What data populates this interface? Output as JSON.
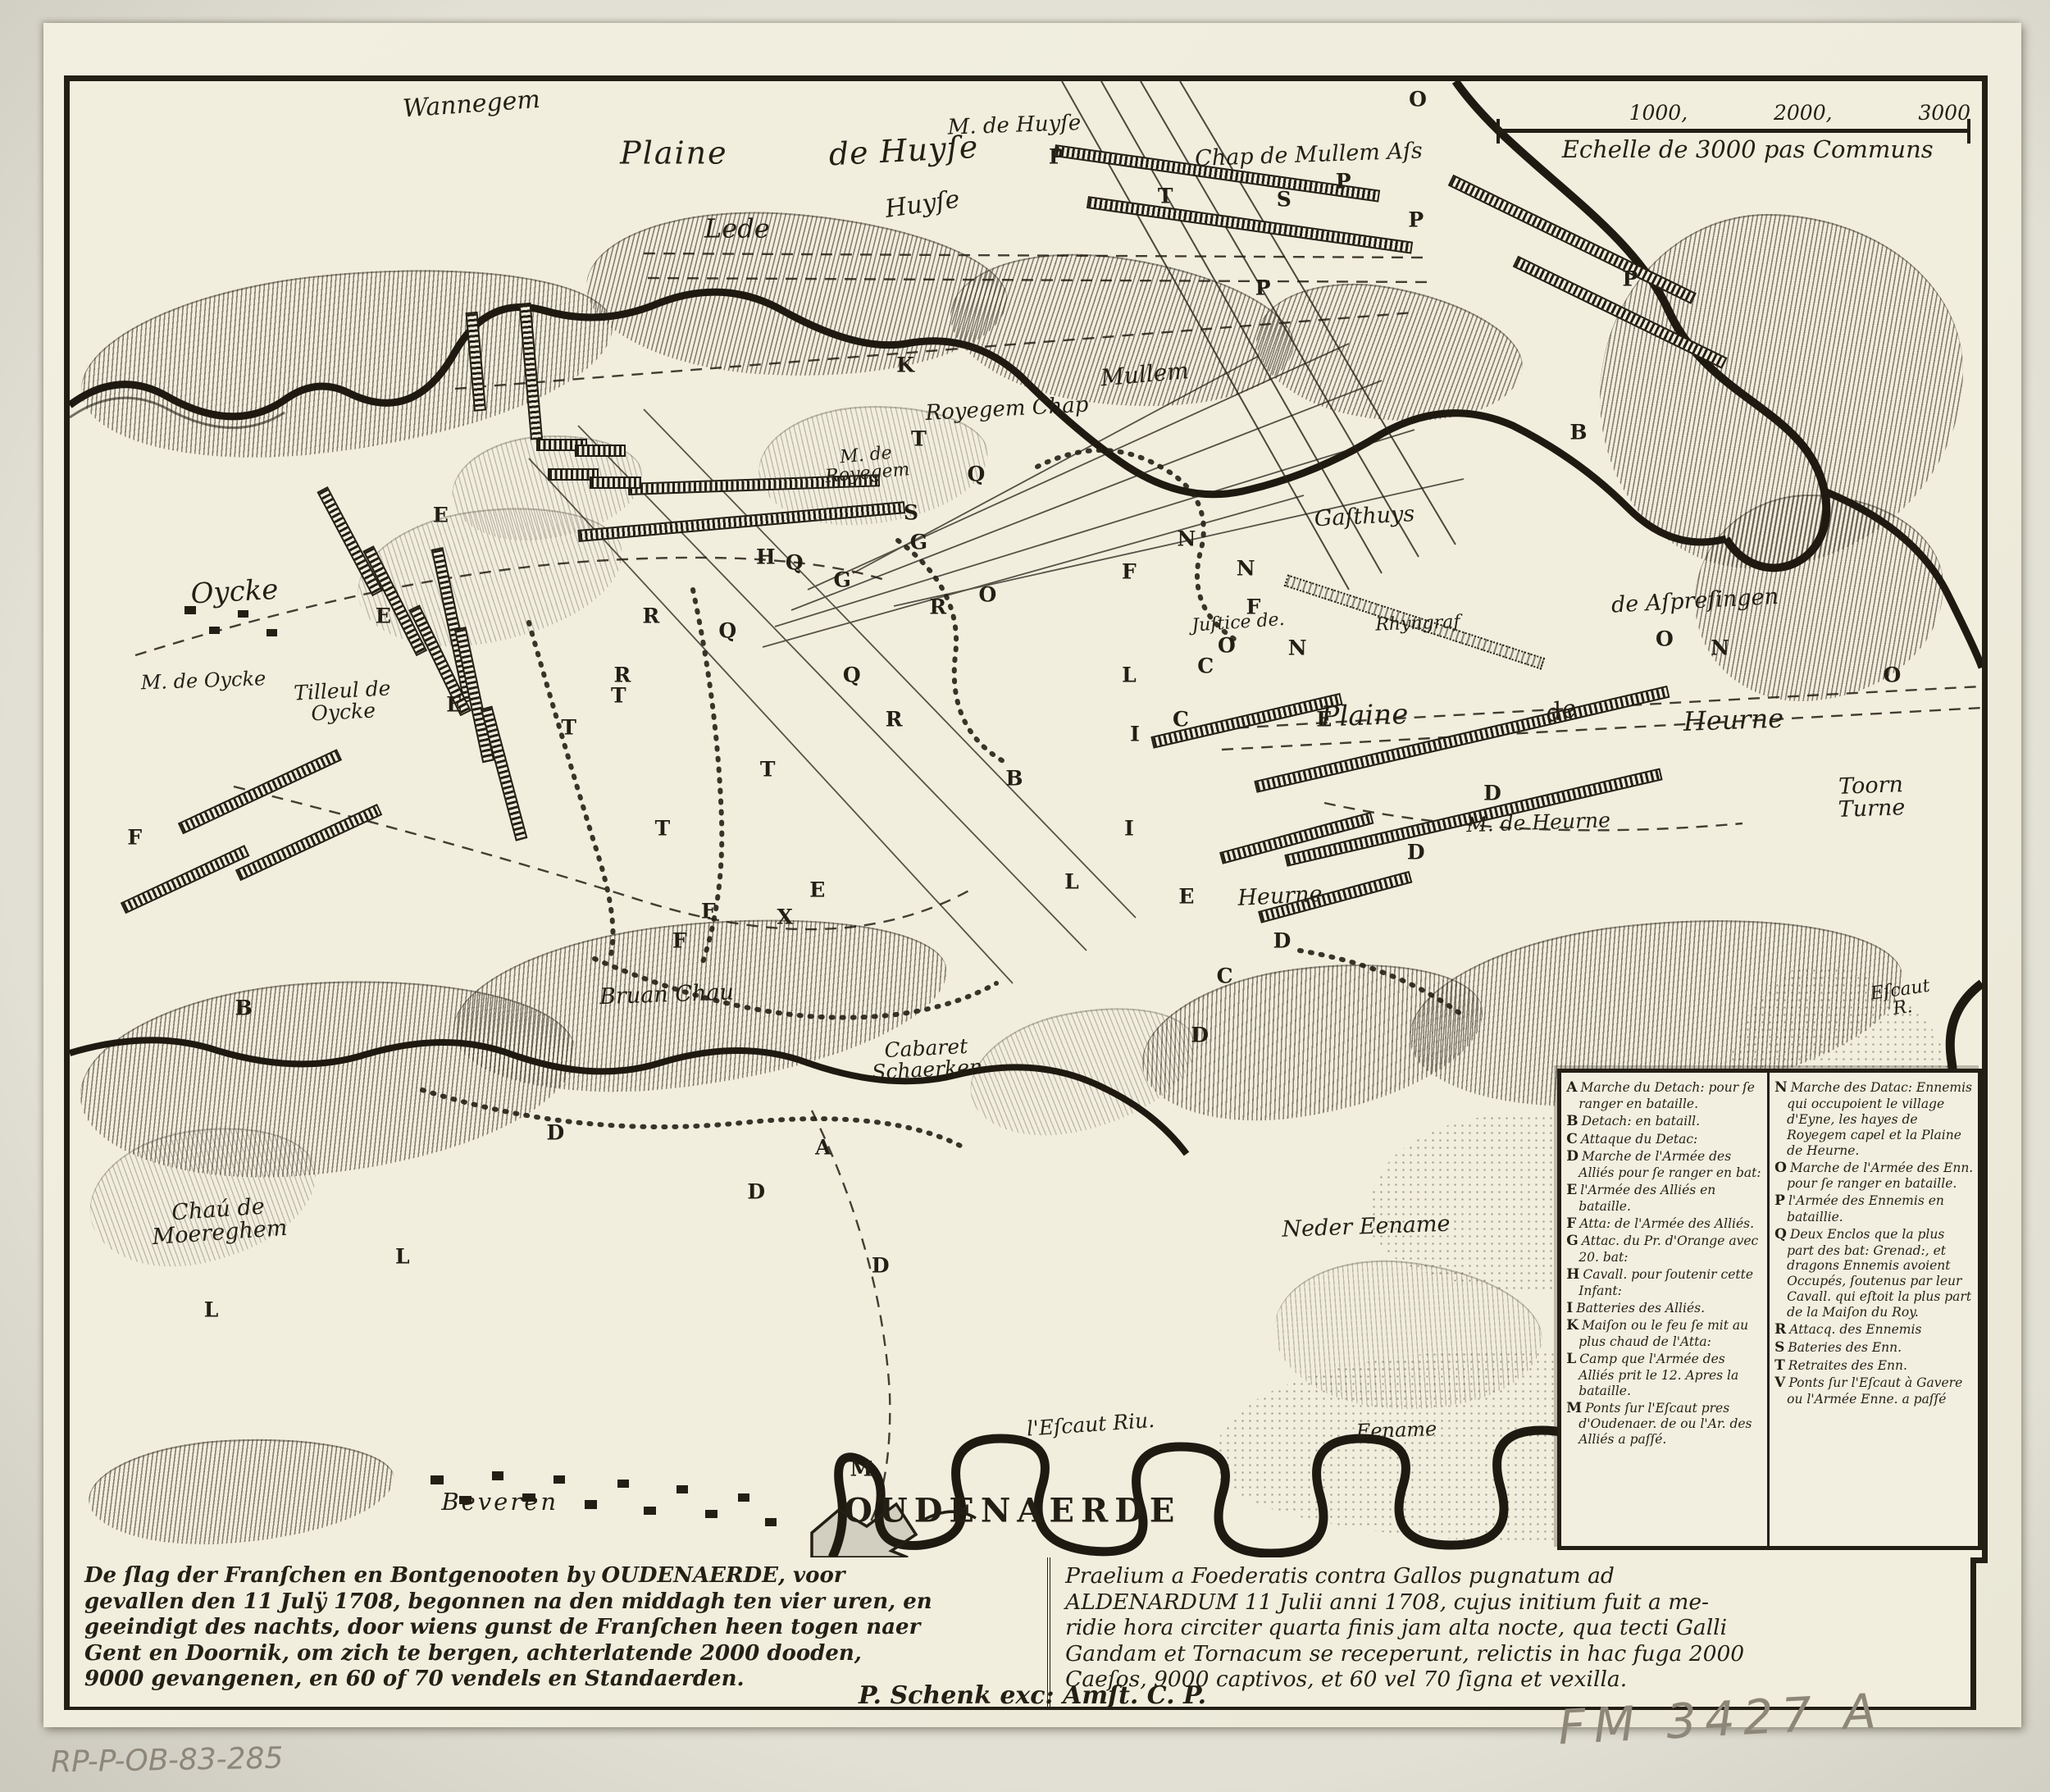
{
  "colors": {
    "ink": "#241f15",
    "paper": "#f1eede",
    "pencil": "#8d8779"
  },
  "scale_bar": {
    "prefix_letter": "O",
    "ticks": [
      "1000,",
      "2000,",
      "3000"
    ],
    "caption": "Echelle de 3000 pas Communs"
  },
  "map_labels": [
    {
      "text": "Wannegem",
      "x": 21.0,
      "y": 1.6,
      "size": 30,
      "rot": -4
    },
    {
      "text": "M. de Huyſe",
      "x": 49.4,
      "y": 3.0,
      "size": 26,
      "rot": -2
    },
    {
      "text": "Plaine",
      "x": 31.6,
      "y": 4.9,
      "size": 38,
      "rot": 0,
      "ls": 2
    },
    {
      "text": "de Huyſe",
      "x": 43.6,
      "y": 4.7,
      "size": 38,
      "rot": -3,
      "ls": 1
    },
    {
      "text": "Chap de Mullem Aſs",
      "x": 64.8,
      "y": 5.0,
      "size": 27,
      "rot": -2
    },
    {
      "text": "Lede",
      "x": 34.9,
      "y": 10.0,
      "size": 32,
      "rot": 0
    },
    {
      "text": "Huyſe",
      "x": 44.6,
      "y": 8.4,
      "size": 30,
      "rot": -8
    },
    {
      "text": "Mullem",
      "x": 56.2,
      "y": 19.9,
      "size": 28,
      "rot": -5
    },
    {
      "text": "Royegem Chap",
      "x": 49.0,
      "y": 22.2,
      "size": 26,
      "rot": -3
    },
    {
      "text": "M. de\nRoyegem",
      "x": 41.7,
      "y": 26.0,
      "size": 22,
      "rot": -5
    },
    {
      "text": "Gaſthuys",
      "x": 67.7,
      "y": 29.5,
      "size": 27,
      "rot": -3
    },
    {
      "text": "de Aſpreſingen",
      "x": 85.0,
      "y": 35.2,
      "size": 27,
      "rot": -3
    },
    {
      "text": "Juſtice de.",
      "x": 61.1,
      "y": 36.7,
      "size": 22,
      "rot": -4
    },
    {
      "text": "Rhyngraf",
      "x": 70.5,
      "y": 36.8,
      "size": 22,
      "rot": -2
    },
    {
      "text": "Oycke",
      "x": 8.6,
      "y": 34.6,
      "size": 34,
      "rot": -3
    },
    {
      "text": "M. de Oycke",
      "x": 7.0,
      "y": 40.6,
      "size": 24,
      "rot": -2
    },
    {
      "text": "Tilleul de\nOycke",
      "x": 14.3,
      "y": 42.0,
      "size": 25,
      "rot": -3
    },
    {
      "text": "Plaine",
      "x": 67.7,
      "y": 43.0,
      "size": 34,
      "rot": -2
    },
    {
      "text": "de",
      "x": 78.0,
      "y": 42.7,
      "size": 30,
      "rot": -12
    },
    {
      "text": "Heurne",
      "x": 87.0,
      "y": 43.3,
      "size": 32,
      "rot": -2
    },
    {
      "text": "Toorn\nTurne",
      "x": 94.2,
      "y": 48.5,
      "size": 27,
      "rot": -2
    },
    {
      "text": "M. de Heurne",
      "x": 76.8,
      "y": 50.2,
      "size": 25,
      "rot": -2
    },
    {
      "text": "Heurne",
      "x": 63.3,
      "y": 55.2,
      "size": 27,
      "rot": -3
    },
    {
      "text": "Bruan Chau",
      "x": 31.2,
      "y": 61.9,
      "size": 27,
      "rot": -2
    },
    {
      "text": "Cabaret\nSchaerken",
      "x": 44.8,
      "y": 66.2,
      "size": 25,
      "rot": -3
    },
    {
      "text": "Chaú de\nMoereghem",
      "x": 7.8,
      "y": 77.2,
      "size": 27,
      "rot": -4
    },
    {
      "text": "Neder Eename",
      "x": 67.8,
      "y": 77.6,
      "size": 27,
      "rot": -2
    },
    {
      "text": "Eename",
      "x": 69.4,
      "y": 91.4,
      "size": 24,
      "rot": -2
    },
    {
      "text": "l'Eſcaut Riu.",
      "x": 53.4,
      "y": 91.0,
      "size": 25,
      "rot": -4
    },
    {
      "text": "Beveren",
      "x": 22.5,
      "y": 96.3,
      "size": 29,
      "rot": 0,
      "ls": 3
    },
    {
      "text": "OUDENAERDE",
      "x": 49.3,
      "y": 96.9,
      "size": 40,
      "rot": 0,
      "ls": 8,
      "caps": true
    },
    {
      "text": "Eſcaut R.",
      "x": 95.8,
      "y": 62.2,
      "size": 22,
      "rot": -8
    }
  ],
  "troop_letters": [
    {
      "t": "P",
      "x": 51.6,
      "y": 5.1
    },
    {
      "t": "P",
      "x": 66.6,
      "y": 6.8
    },
    {
      "t": "P",
      "x": 62.4,
      "y": 14.0
    },
    {
      "t": "P",
      "x": 81.6,
      "y": 13.4
    },
    {
      "t": "P",
      "x": 70.4,
      "y": 9.4
    },
    {
      "t": "T",
      "x": 57.3,
      "y": 7.8
    },
    {
      "t": "T",
      "x": 44.4,
      "y": 24.2
    },
    {
      "t": "T",
      "x": 28.7,
      "y": 41.6
    },
    {
      "t": "T",
      "x": 36.5,
      "y": 46.6
    },
    {
      "t": "T",
      "x": 31.0,
      "y": 50.6
    },
    {
      "t": "T",
      "x": 26.1,
      "y": 43.8
    },
    {
      "t": "S",
      "x": 63.5,
      "y": 8.0
    },
    {
      "t": "S",
      "x": 44.0,
      "y": 29.2
    },
    {
      "t": "K",
      "x": 43.7,
      "y": 19.2
    },
    {
      "t": "O",
      "x": 48.0,
      "y": 34.8
    },
    {
      "t": "O",
      "x": 60.5,
      "y": 38.2
    },
    {
      "t": "O",
      "x": 83.4,
      "y": 37.8
    },
    {
      "t": "O",
      "x": 95.3,
      "y": 40.2
    },
    {
      "t": "N",
      "x": 58.4,
      "y": 31.0
    },
    {
      "t": "N",
      "x": 64.2,
      "y": 38.4
    },
    {
      "t": "N",
      "x": 86.3,
      "y": 38.4
    },
    {
      "t": "N",
      "x": 61.5,
      "y": 33.0
    },
    {
      "t": "Q",
      "x": 47.4,
      "y": 26.6
    },
    {
      "t": "Q",
      "x": 37.9,
      "y": 32.6
    },
    {
      "t": "Q",
      "x": 34.4,
      "y": 37.2
    },
    {
      "t": "Q",
      "x": 40.9,
      "y": 40.2
    },
    {
      "t": "G",
      "x": 44.4,
      "y": 31.2
    },
    {
      "t": "G",
      "x": 40.4,
      "y": 33.8
    },
    {
      "t": "H",
      "x": 36.4,
      "y": 32.2
    },
    {
      "t": "E",
      "x": 19.4,
      "y": 29.4
    },
    {
      "t": "E",
      "x": 16.4,
      "y": 36.2
    },
    {
      "t": "E",
      "x": 20.1,
      "y": 42.2
    },
    {
      "t": "E",
      "x": 65.6,
      "y": 43.2
    },
    {
      "t": "E",
      "x": 58.4,
      "y": 55.2
    },
    {
      "t": "E",
      "x": 39.1,
      "y": 54.8
    },
    {
      "t": "R",
      "x": 30.4,
      "y": 36.2
    },
    {
      "t": "R",
      "x": 28.9,
      "y": 40.2
    },
    {
      "t": "R",
      "x": 45.4,
      "y": 35.6
    },
    {
      "t": "R",
      "x": 43.1,
      "y": 43.2
    },
    {
      "t": "I",
      "x": 55.7,
      "y": 44.2
    },
    {
      "t": "I",
      "x": 55.4,
      "y": 50.6
    },
    {
      "t": "L",
      "x": 55.4,
      "y": 40.2
    },
    {
      "t": "L",
      "x": 52.4,
      "y": 54.2
    },
    {
      "t": "L",
      "x": 7.4,
      "y": 83.2
    },
    {
      "t": "L",
      "x": 17.4,
      "y": 79.6
    },
    {
      "t": "C",
      "x": 59.4,
      "y": 39.6
    },
    {
      "t": "C",
      "x": 58.1,
      "y": 43.2
    },
    {
      "t": "C",
      "x": 60.4,
      "y": 60.6
    },
    {
      "t": "D",
      "x": 74.4,
      "y": 48.2
    },
    {
      "t": "D",
      "x": 70.4,
      "y": 52.2
    },
    {
      "t": "D",
      "x": 63.4,
      "y": 58.2
    },
    {
      "t": "D",
      "x": 59.1,
      "y": 64.6
    },
    {
      "t": "D",
      "x": 35.9,
      "y": 75.2
    },
    {
      "t": "D",
      "x": 42.4,
      "y": 80.2
    },
    {
      "t": "D",
      "x": 25.4,
      "y": 71.2
    },
    {
      "t": "F",
      "x": 33.4,
      "y": 56.2
    },
    {
      "t": "F",
      "x": 31.9,
      "y": 58.2
    },
    {
      "t": "F",
      "x": 55.4,
      "y": 33.2
    },
    {
      "t": "F",
      "x": 3.4,
      "y": 51.2
    },
    {
      "t": "F",
      "x": 61.9,
      "y": 35.6
    },
    {
      "t": "B",
      "x": 49.4,
      "y": 47.2
    },
    {
      "t": "B",
      "x": 78.9,
      "y": 23.8
    },
    {
      "t": "B",
      "x": 9.1,
      "y": 62.8
    },
    {
      "t": "A",
      "x": 39.4,
      "y": 72.2
    },
    {
      "t": "M",
      "x": 41.4,
      "y": 94.0
    },
    {
      "t": "X",
      "x": 37.4,
      "y": 56.6
    },
    {
      "t": "O",
      "x": 70.5,
      "y": 1.2
    }
  ],
  "legend": {
    "left": [
      {
        "key": "A",
        "text": "Marche du Detach: pour ſe ranger en bataille."
      },
      {
        "key": "B",
        "text": "Detach: en bataill."
      },
      {
        "key": "C",
        "text": "Attaque du Detac:"
      },
      {
        "key": "D",
        "text": "Marche de l'Armée des Alliés pour ſe ranger en bat:"
      },
      {
        "key": "E",
        "text": "l'Armée des Alliés en bataille."
      },
      {
        "key": "F",
        "text": "Atta: de l'Armée des Alliés."
      },
      {
        "key": "G",
        "text": "Attac. du Pr. d'Orange avec 20. bat:"
      },
      {
        "key": "H",
        "text": "Cavall. pour ſoutenir cette Infant:"
      },
      {
        "key": "I",
        "text": "Batteries des Alliés."
      },
      {
        "key": "K",
        "text": "Maiſon ou le feu ſe mit au plus chaud de l'Atta:"
      },
      {
        "key": "L",
        "text": "Camp que l'Armée des Alliés prit le 12. Apres la bataille."
      },
      {
        "key": "M",
        "text": "Ponts ſur l'Eſcaut pres d'Oudenaer. de ou l'Ar. des Alliés a paſſé."
      }
    ],
    "right": [
      {
        "key": "N",
        "text": "Marche des Datac: Ennemis qui occupoient le village d'Eyne, les hayes de Royegem capel et la Plaine de Heurne."
      },
      {
        "key": "O",
        "text": "Marche de l'Armée des Enn. pour ſe ranger en bataille."
      },
      {
        "key": "P",
        "text": "l'Armée des Ennemis en bataillie."
      },
      {
        "key": "Q",
        "text": "Deux Enclos que la plus part des bat: Grenad:, et dragons Ennemis avoient Occupés, ſoutenus par leur Cavall. qui eſtoit la plus part de la Maiſon du Roy."
      },
      {
        "key": "R",
        "text": "Attacq. des Ennemis"
      },
      {
        "key": "S",
        "text": "Bateries des Enn."
      },
      {
        "key": "T",
        "text": "Retraites des Enn."
      },
      {
        "key": "V",
        "text": "Ponts ſur l'Eſcaut à Gavere ou l'Armée Enne. a paſſé"
      }
    ]
  },
  "captions": {
    "dutch_lines": [
      "De ſlag der Franſchen en Bontgenooten by OUDENAERDE, voor",
      "gevallen den 11 Julÿ 1708, begonnen na den middagh ten vier uren, en",
      "geeindigt des nachts, door wiens gunst de Franſchen heen togen naer",
      "Gent en Doornik, om zich te bergen, achterlatende 2000 dooden,",
      "9000 gevangenen, en 60 of 70 vendels en Standaerden."
    ],
    "latin_lines": [
      "Praelium a Foederatis contra Gallos pugnatum ad",
      "ALDENARDUM 11 Julii anni 1708, cujus initium fuit a me-",
      "ridie hora circiter quarta finis jam alta nocte, qua tecti Galli",
      "Gandam et Tornacum se receperunt, relictis in hac fuga 2000",
      "Caeſos, 9000 captivos, et 60 vel 70 ſigna et vexilla."
    ]
  },
  "imprint": "P. Schenk exc: Amſt. C. P.",
  "annotations": {
    "bottom_left": "RP-P-OB-83-285",
    "bottom_right": "FM 3427 A"
  }
}
